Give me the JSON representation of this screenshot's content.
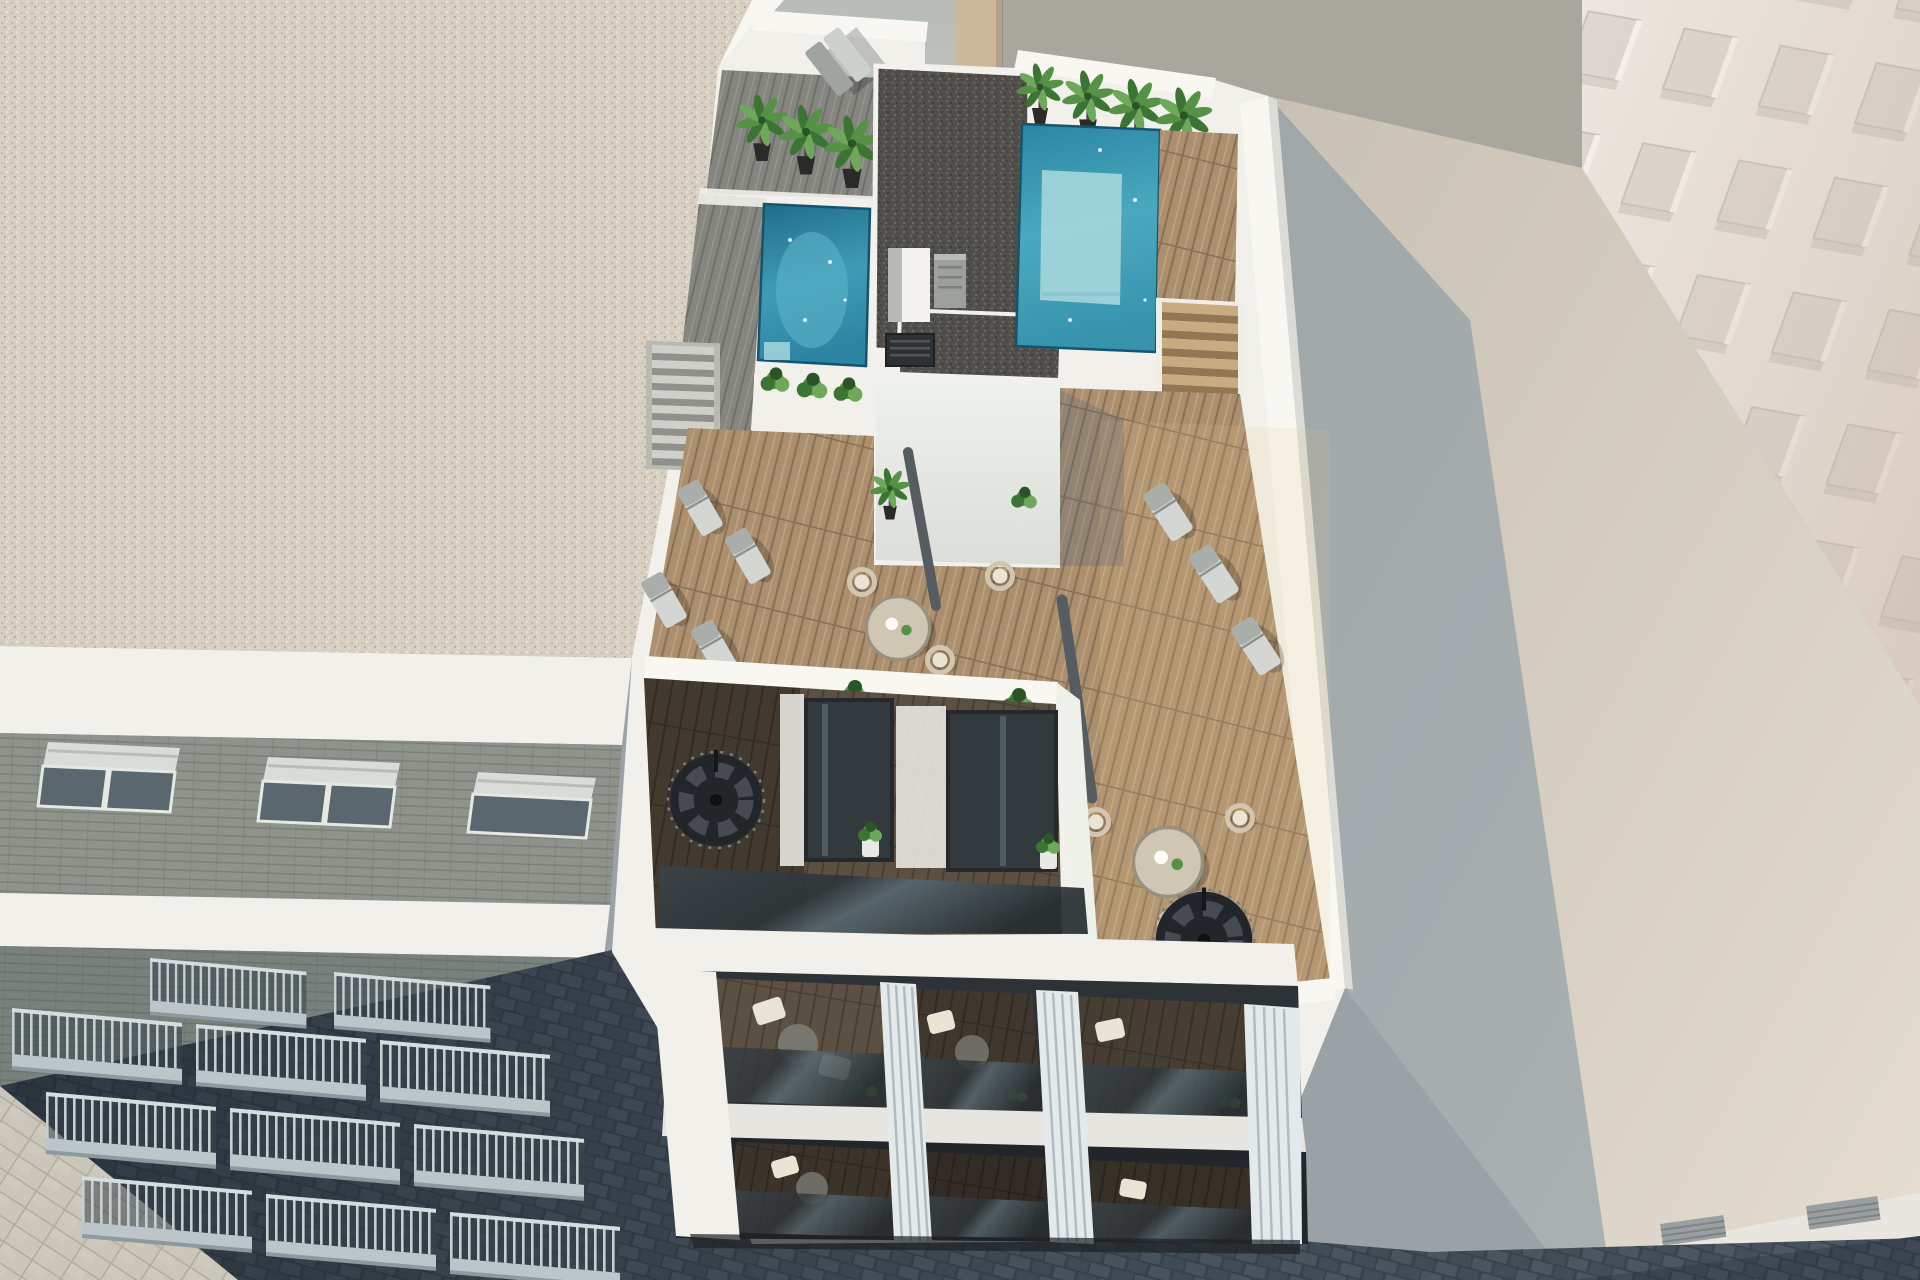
{
  "scene": {
    "title": "Aerial 3D architectural render of a new apartment building with rooftop pool terrace",
    "main_building": {
      "label": "white apartment building with rooftop terrace, two plunge pools, wood deck, loungers and spiral staircases",
      "roof": {
        "pools": 2,
        "palm_plants": 7,
        "sun_loungers": 8,
        "lounge_chairs": 6,
        "round_tables": 2,
        "closed_umbrellas": 2,
        "planters": 4,
        "gravel_roof_sections": 2,
        "stairs": 2
      },
      "floors": {
        "balcony_levels": 3,
        "spiral_staircases": 2,
        "louver_fin_pilasters": 4
      }
    },
    "left_building": {
      "label": "neighboring stone apartment block with gravel roof, shuttered windows and railed balconies",
      "window_groups": 3,
      "balcony_rows": 3
    },
    "right_tower": {
      "label": "tall sunlit white building with recessed window grid"
    },
    "right_roof": {
      "label": "flat neighboring roof with cast building shadow"
    },
    "street": {
      "label": "dark cobbled street"
    },
    "sidewalk": {
      "label": "light paved sidewalk"
    }
  },
  "palette": {
    "bgWall": "#b4bab3",
    "bgWall2": "#a9a69e",
    "tanPillar": "#ccb89c",
    "whiteBright": "#f8f7f2",
    "whiteSoft": "#f1f0ea",
    "whiteShade": "#dadcd5",
    "gravelBeige": "#d7d0c2",
    "gravelBeigeDot1": "#c0b4a0",
    "gravelBeigeDot2": "#efe8da",
    "gravelBeigeDot3": "#a69a85",
    "gravelDark": "#514f4a",
    "gravelDarkDot1": "#6b6a64",
    "gravelDarkDot2": "#3b3a36",
    "gravelDarkDot3": "#7d7c75",
    "poolDeep": "#1f6c8a",
    "poolMid": "#3f9cb6",
    "poolLight": "#58b1c6",
    "poolPale": "#a6d6dc",
    "poolEdge": "#15546e",
    "woodWarm": "#ab8f6f",
    "woodWarmLine": "#8a7154",
    "woodWarmHi": "#c2a57d",
    "woodGray": "#84867f",
    "woodGrayLine": "#6c6e67",
    "woodGrayHi": "#989a92",
    "woodDark": "#5c5042",
    "woodDarkLine": "#483e32",
    "green1": "#3c7434",
    "green2": "#569246",
    "green3": "#6fa85a",
    "greenDark": "#2a5526",
    "potDark": "#2b2a28",
    "potWhite": "#e8e8e4",
    "trunk": "#4a4336",
    "loungerLight": "#d3d6d2",
    "loungerMid": "#a9aeaa",
    "rattan": "#d3c6b0",
    "cushion": "#eae4d4",
    "tableTop": "#cfc6b4",
    "tableRim": "#98917f",
    "umbrella": "#565d60",
    "stairDark": "#22262a",
    "stairMid": "#454b50",
    "glassDark": "#2e3539",
    "glassLight": "#6e8089",
    "brick": "#8e948b",
    "brickLine": "#7a8077",
    "balcSlab": "#bcc6ca",
    "balcBar": "#c6cfd2",
    "balcShadow": "#434d55",
    "paver": "#cbc6ba",
    "paverLine": "#b1aca0",
    "cobble": "#3c4650",
    "cobbleStone": "#4e5963",
    "cobbleStone2": "#45505a",
    "towerBase": "#ece7e0",
    "towerWin": "#dbd6cf",
    "towerWinEdge": "#c6c0b8",
    "roofLit": "#cfc8bb",
    "roofLit2": "#e2dbce",
    "fascia": "#e9e6df",
    "vent": "#9aa0a2",
    "entrance": "#1d2125"
  }
}
